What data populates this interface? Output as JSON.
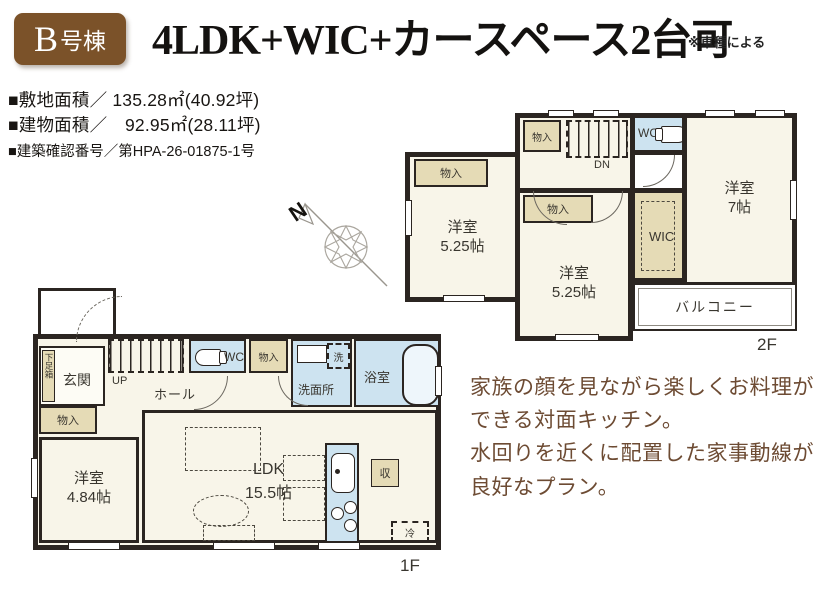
{
  "badge": {
    "initial": "B",
    "suffix": "号棟"
  },
  "header": {
    "title": "4LDK+WIC+カースペース2台可",
    "note": "※車種による"
  },
  "details": {
    "site_area": "■敷地面積／ 135.28㎡(40.92坪)",
    "building_area": "■建物面積／　92.95㎡(28.11坪)",
    "building_confirmation": "■建築確認番号／第HPA-26-01875-1号"
  },
  "compass": {
    "north": "N"
  },
  "labels": {
    "closet": "物入",
    "wc": "WC",
    "wic": "WIC",
    "dn": "DN",
    "up": "UP",
    "hall": "ホール",
    "genkan": "玄関",
    "shoe_box": "下足箱",
    "washroom": "洗面所",
    "washer": "洗",
    "bath": "浴室",
    "balcony": "バルコニー",
    "storage": "収",
    "fridge": "冷"
  },
  "floor2": {
    "floor_label": "2F",
    "room_west": {
      "name": "洋室",
      "size": "5.25帖"
    },
    "room_center": {
      "name": "洋室",
      "size": "5.25帖"
    },
    "room_east": {
      "name": "洋室",
      "size": "7帖"
    }
  },
  "floor1": {
    "floor_label": "1F",
    "room_west": {
      "name": "洋室",
      "size": "4.84帖"
    },
    "ldk": {
      "name": "LDK",
      "size": "15.5帖"
    }
  },
  "description": {
    "lines": [
      "家族の顔を見ながら楽しくお料理が",
      "できる対面キッチン。",
      "水回りを近くに配置した家事動線が",
      "良好なプラン。"
    ]
  }
}
